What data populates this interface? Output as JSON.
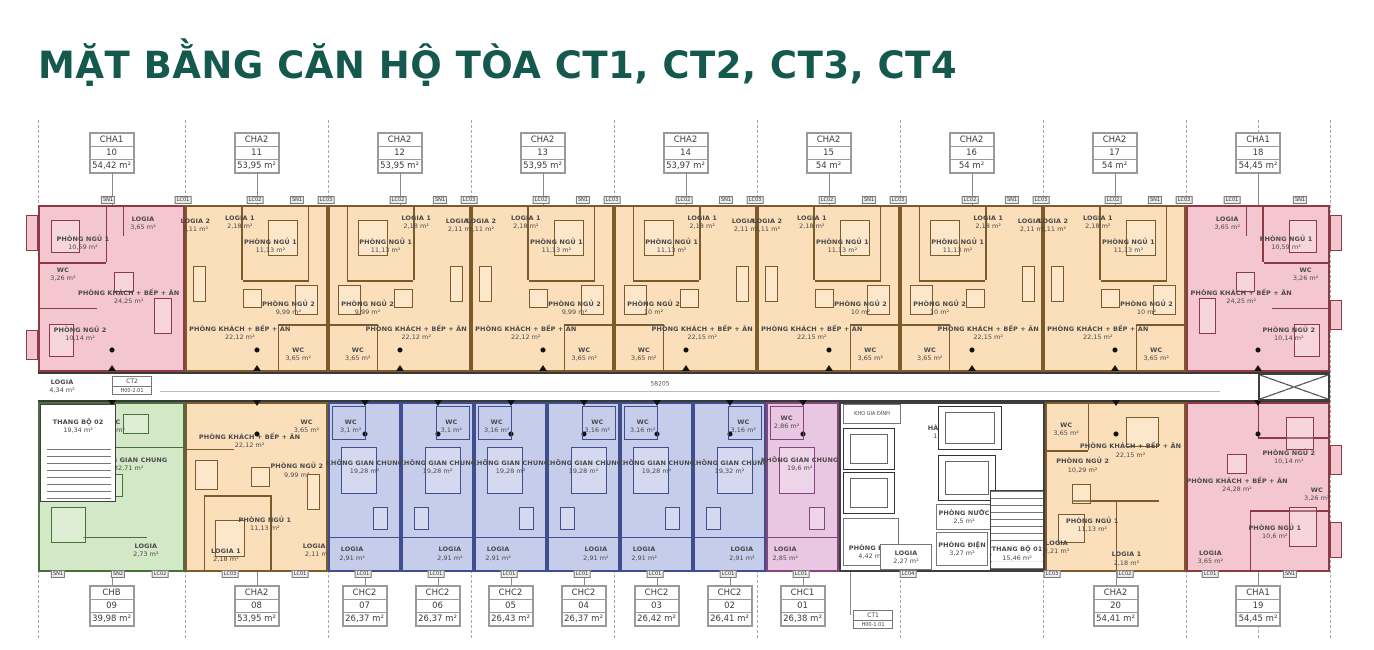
{
  "title": "MẶT BẰNG CĂN HỘ TÒA CT1, CT2, CT3, CT4",
  "colors": {
    "title": "#15584d",
    "cha1_fill": "#f4c7d0",
    "cha1_wall": "#8d3a47",
    "cha2_fill": "#fbdfba",
    "cha2_wall": "#7d5a2a",
    "chb_fill": "#d2e8c6",
    "chb_wall": "#47703a",
    "chc2_fill": "#c6cdeb",
    "chc2_wall": "#3f4e8f",
    "chc1_fill": "#e9c6e2",
    "chc1_wall": "#84477c"
  },
  "top_units": [
    {
      "type": "CHA1",
      "no": "10",
      "area": "54,42 m²"
    },
    {
      "type": "CHA2",
      "no": "11",
      "area": "53,95 m²"
    },
    {
      "type": "CHA2",
      "no": "12",
      "area": "53,95 m²"
    },
    {
      "type": "CHA2",
      "no": "13",
      "area": "53,95 m²"
    },
    {
      "type": "CHA2",
      "no": "14",
      "area": "53,97 m²"
    },
    {
      "type": "CHA2",
      "no": "15",
      "area": "54 m²"
    },
    {
      "type": "CHA2",
      "no": "16",
      "area": "54 m²"
    },
    {
      "type": "CHA2",
      "no": "17",
      "area": "54 m²"
    },
    {
      "type": "CHA1",
      "no": "18",
      "area": "54,45 m²"
    }
  ],
  "bottom_units": [
    {
      "type": "CHB",
      "no": "09",
      "area": "39,98 m²"
    },
    {
      "type": "CHA2",
      "no": "08",
      "area": "53,95 m²"
    },
    {
      "type": "CHC2",
      "no": "07",
      "area": "26,37 m²"
    },
    {
      "type": "CHC2",
      "no": "06",
      "area": "26,37 m²"
    },
    {
      "type": "CHC2",
      "no": "05",
      "area": "26,43 m²"
    },
    {
      "type": "CHC2",
      "no": "04",
      "area": "26,37 m²"
    },
    {
      "type": "CHC2",
      "no": "03",
      "area": "26,42 m²"
    },
    {
      "type": "CHC2",
      "no": "02",
      "area": "26,41 m²"
    },
    {
      "type": "CHC1",
      "no": "01",
      "area": "26,38 m²"
    },
    {
      "type": "CHA2",
      "no": "20",
      "area": "54,41 m²"
    },
    {
      "type": "CHA1",
      "no": "19",
      "area": "54,45 m²"
    }
  ],
  "rooms_by_unit": {
    "u10": [
      {
        "n": "PHÒNG NGỦ 1",
        "a": "10,59 m²"
      },
      {
        "n": "LOGIA",
        "a": "3,65 m²"
      },
      {
        "n": "WC",
        "a": "3,26 m²"
      },
      {
        "n": "PHÒNG KHÁCH + BẾP + ĂN",
        "a": "24,25 m²"
      },
      {
        "n": "PHÒNG NGỦ 2",
        "a": "10,14 m²"
      }
    ],
    "u11": [
      {
        "n": "LOGIA 1",
        "a": "2,18 m²"
      },
      {
        "n": "PHÒNG NGỦ 1",
        "a": "11,13 m²"
      },
      {
        "n": "LOGIA 2",
        "a": "2,11 m²"
      },
      {
        "n": "PHÒNG NGỦ 2",
        "a": "9,99 m²"
      },
      {
        "n": "PHÒNG KHÁCH + BẾP + ĂN",
        "a": "22,12 m²"
      },
      {
        "n": "WC",
        "a": "3,65 m²"
      }
    ],
    "u12": [
      {
        "n": "LOGIA 1",
        "a": "2,18 m²"
      },
      {
        "n": "PHÒNG NGỦ 1",
        "a": "11,13 m²"
      },
      {
        "n": "LOGIA 2",
        "a": "2,11 m²"
      },
      {
        "n": "PHÒNG NGỦ 2",
        "a": "9,99 m²"
      },
      {
        "n": "PHÒNG KHÁCH + BẾP + ĂN",
        "a": "22,12 m²"
      },
      {
        "n": "WC",
        "a": "3,65 m²"
      }
    ],
    "u13": [
      {
        "n": "LOGIA 1",
        "a": "2,18 m²"
      },
      {
        "n": "PHÒNG NGỦ 1",
        "a": "11,13 m²"
      },
      {
        "n": "LOGIA 2",
        "a": "2,11 m²"
      },
      {
        "n": "PHÒNG NGỦ 2",
        "a": "9,99 m²"
      },
      {
        "n": "PHÒNG KHÁCH + BẾP + ĂN",
        "a": "22,12 m²"
      },
      {
        "n": "WC",
        "a": "3,65 m²"
      }
    ],
    "u14": [
      {
        "n": "LOGIA 1",
        "a": "2,18 m²"
      },
      {
        "n": "PHÒNG NGỦ 1",
        "a": "11,13 m²"
      },
      {
        "n": "LOGIA 2",
        "a": "2,11 m²"
      },
      {
        "n": "PHÒNG NGỦ 2",
        "a": "10 m²"
      },
      {
        "n": "PHÒNG KHÁCH + BẾP + ĂN",
        "a": "22,15 m²"
      },
      {
        "n": "WC",
        "a": "3,65 m²"
      }
    ],
    "u15": [
      {
        "n": "LOGIA 1",
        "a": "2,18 m²"
      },
      {
        "n": "PHÒNG NGỦ 1",
        "a": "11,13 m²"
      },
      {
        "n": "LOGIA 2",
        "a": "2,11 m²"
      },
      {
        "n": "PHÒNG NGỦ 2",
        "a": "10 m²"
      },
      {
        "n": "PHÒNG KHÁCH + BẾP + ĂN",
        "a": "22,15 m²"
      },
      {
        "n": "WC",
        "a": "3,65 m²"
      }
    ],
    "u16": [
      {
        "n": "LOGIA 1",
        "a": "2,18 m²"
      },
      {
        "n": "PHÒNG NGỦ 1",
        "a": "11,13 m²"
      },
      {
        "n": "LOGIA 2",
        "a": "2,11 m²"
      },
      {
        "n": "PHÒNG NGỦ 2",
        "a": "10 m²"
      },
      {
        "n": "PHÒNG KHÁCH + BẾP + ĂN",
        "a": "22,15 m²"
      },
      {
        "n": "WC",
        "a": "3,65 m²"
      }
    ],
    "u17": [
      {
        "n": "LOGIA 1",
        "a": "2,18 m²"
      },
      {
        "n": "PHÒNG NGỦ 1",
        "a": "11,13 m²"
      },
      {
        "n": "LOGIA 2",
        "a": "2,11 m²"
      },
      {
        "n": "PHÒNG NGỦ 2",
        "a": "10 m²"
      },
      {
        "n": "PHÒNG KHÁCH + BẾP + ĂN",
        "a": "22,15 m²"
      },
      {
        "n": "WC",
        "a": "3,65 m²"
      }
    ],
    "u18": [
      {
        "n": "PHÒNG NGỦ 1",
        "a": "10,59 m²"
      },
      {
        "n": "LOGIA",
        "a": "3,65 m²"
      },
      {
        "n": "WC",
        "a": "3,26 m²"
      },
      {
        "n": "PHÒNG KHÁCH + BẾP + ĂN",
        "a": "24,25 m²"
      },
      {
        "n": "PHÒNG NGỦ 2",
        "a": "10,14 m²"
      }
    ],
    "u09": [
      {
        "n": "WC",
        "a": "3,3 m²"
      },
      {
        "n": "KHÔNG GIAN CHUNG",
        "a": "32,71 m²"
      },
      {
        "n": "LOGIA",
        "a": "2,73 m²"
      }
    ],
    "u08": [
      {
        "n": "PHÒNG KHÁCH + BẾP + ĂN",
        "a": "22,12 m²"
      },
      {
        "n": "WC",
        "a": "3,65 m²"
      },
      {
        "n": "PHÒNG NGỦ 2",
        "a": "9,99 m²"
      },
      {
        "n": "PHÒNG NGỦ 1",
        "a": "11,13 m²"
      },
      {
        "n": "LOGIA 1",
        "a": "2,18 m²"
      },
      {
        "n": "LOGIA 2",
        "a": "2,11 m²"
      }
    ],
    "u07": [
      {
        "n": "WC",
        "a": "3,1 m²"
      },
      {
        "n": "KHÔNG GIAN CHUNG",
        "a": "19,28 m²"
      },
      {
        "n": "LOGIA",
        "a": "2,91 m²"
      }
    ],
    "u06": [
      {
        "n": "WC",
        "a": "3,1 m²"
      },
      {
        "n": "KHÔNG GIAN CHUNG",
        "a": "19,28 m²"
      },
      {
        "n": "LOGIA",
        "a": "2,91 m²"
      }
    ],
    "u05": [
      {
        "n": "WC",
        "a": "3,16 m²"
      },
      {
        "n": "KHÔNG GIAN CHUNG",
        "a": "19,28 m²"
      },
      {
        "n": "LOGIA",
        "a": "2,91 m²"
      }
    ],
    "u04": [
      {
        "n": "WC",
        "a": "3,16 m²"
      },
      {
        "n": "KHÔNG GIAN CHUNG",
        "a": "19,28 m²"
      },
      {
        "n": "LOGIA",
        "a": "2,91 m²"
      }
    ],
    "u03": [
      {
        "n": "WC",
        "a": "3,16 m²"
      },
      {
        "n": "KHÔNG GIAN CHUNG",
        "a": "19,28 m²"
      },
      {
        "n": "LOGIA",
        "a": "2,91 m²"
      }
    ],
    "u02": [
      {
        "n": "WC",
        "a": "3,16 m²"
      },
      {
        "n": "KHÔNG GIAN CHUNG",
        "a": "19,32 m²"
      },
      {
        "n": "LOGIA",
        "a": "2,91 m²"
      }
    ],
    "u01": [
      {
        "n": "WC",
        "a": "2,86 m²"
      },
      {
        "n": "KHÔNG GIAN CHUNG",
        "a": "19,6 m²"
      },
      {
        "n": "LOGIA",
        "a": "2,85 m²"
      }
    ],
    "u20": [
      {
        "n": "WC",
        "a": "3,65 m²"
      },
      {
        "n": "PHÒNG NGỦ 2",
        "a": "10,29 m²"
      },
      {
        "n": "PHÒNG KHÁCH + BẾP + ĂN",
        "a": "22,15 m²"
      },
      {
        "n": "PHÒNG NGỦ 1",
        "a": "11,13 m²"
      },
      {
        "n": "LOGIA",
        "a": "2,21 m²"
      },
      {
        "n": "LOGIA 1",
        "a": "2,18 m²"
      }
    ],
    "u19": [
      {
        "n": "PHÒNG NGỦ 2",
        "a": "10,14 m²"
      },
      {
        "n": "PHÒNG KHÁCH + BẾP + ĂN",
        "a": "24,28 m²"
      },
      {
        "n": "WC",
        "a": "3,26 m²"
      },
      {
        "n": "PHÒNG NGỦ 1",
        "a": "10,6 m²"
      },
      {
        "n": "LOGIA",
        "a": "3,65 m²"
      }
    ]
  },
  "core": {
    "hanh_lang": {
      "n": "HÀNH LANG",
      "a": "118,97 m²"
    },
    "level": "+7050",
    "dim_main": "58205",
    "dim_core": "3000",
    "kho": {
      "n": "KHO GIA ĐÌNH",
      "a": ""
    },
    "phong_rac": {
      "n": "PHÒNG RÁC",
      "a": "4,42 m²"
    },
    "phong_nuoc": {
      "n": "PHÒNG NƯỚC",
      "a": "2,5 m²"
    },
    "phong_dien": {
      "n": "PHÒNG ĐIỆN",
      "a": "3,27 m²"
    },
    "thang_bo_01": {
      "n": "THANG BỘ 01",
      "a": "15,46 m²"
    },
    "logia": {
      "n": "LOGIA",
      "a": "2,27 m²"
    }
  },
  "left_core": {
    "logia": {
      "n": "LOGIA",
      "a": "4,34 m²"
    },
    "thang_bo_02": {
      "n": "THANG BỘ 02",
      "a": "19,34 m²"
    }
  },
  "blocks": {
    "ct2_name": "CT2",
    "ct2_code": "H00-2.01",
    "ct1_name": "CT1",
    "ct1_code": "H00-1.01"
  },
  "tag_codes": {
    "sn1": "SN1",
    "sn2": "SN2",
    "lc01": "LC01",
    "lc02": "LC02",
    "lc03": "LC03",
    "lc04": "LC04"
  }
}
